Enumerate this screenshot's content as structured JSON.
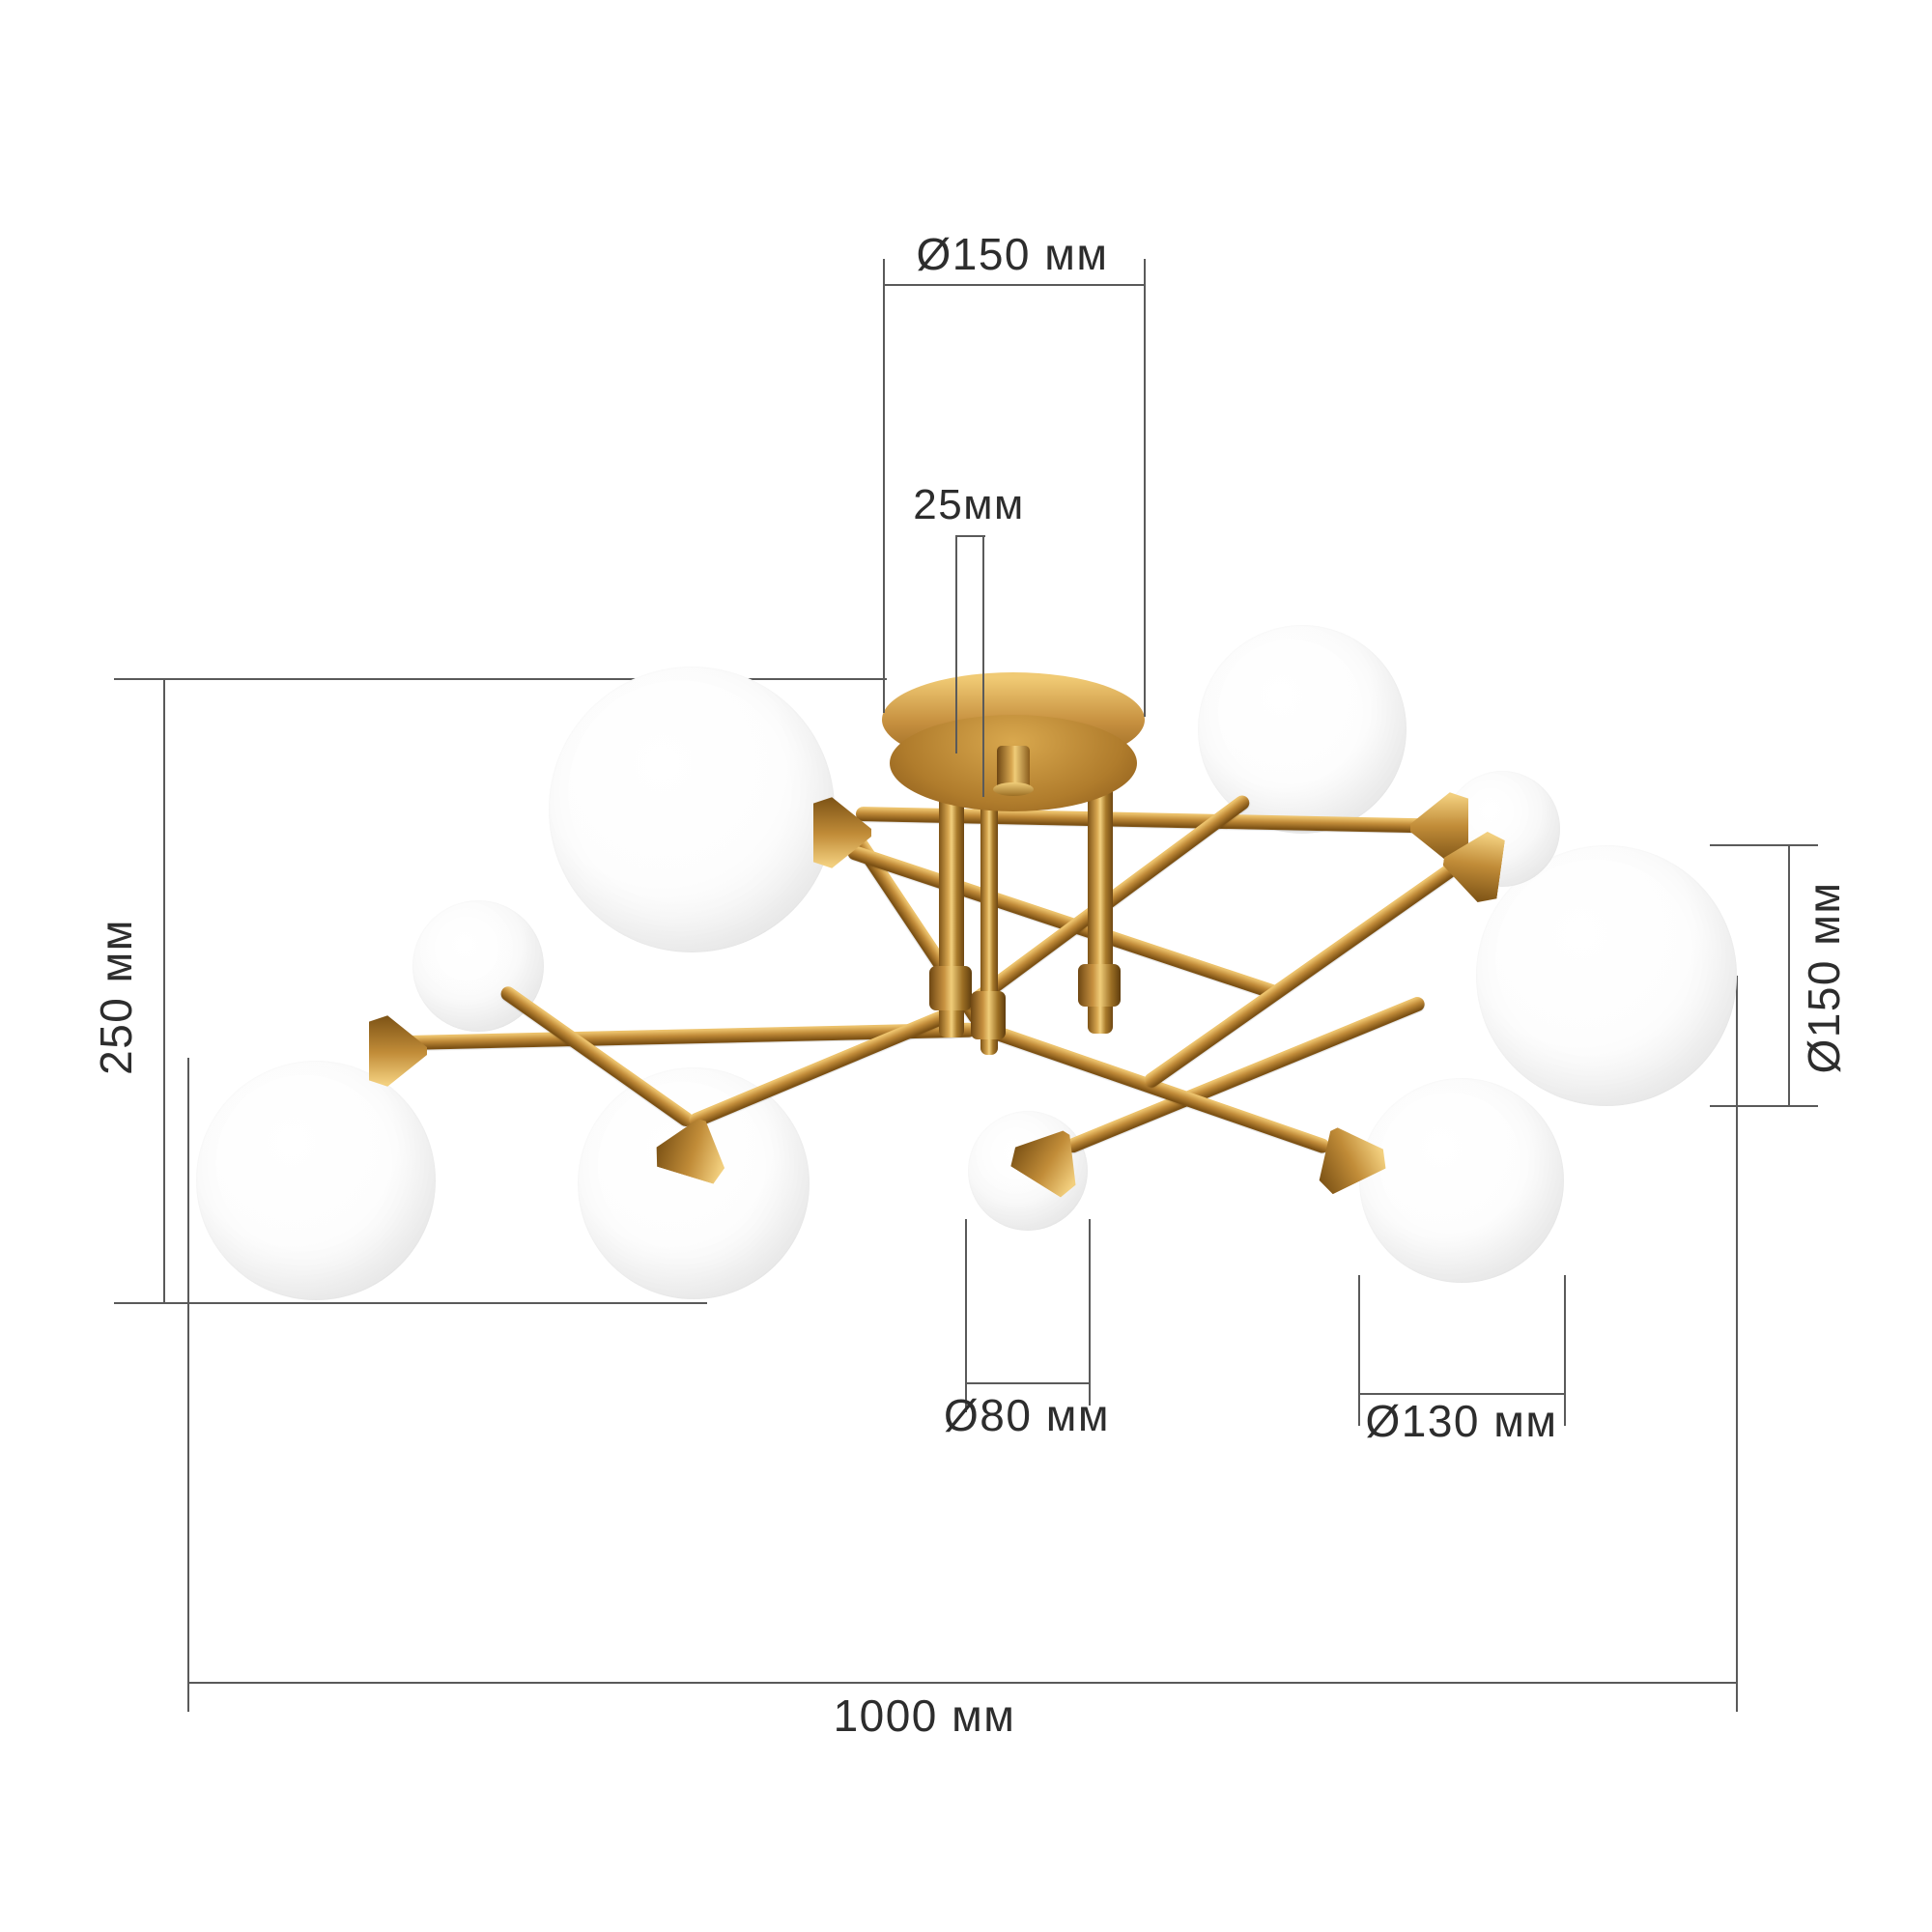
{
  "page": {
    "background": "#ffffff",
    "kind": "product dimension diagram",
    "product": "brass sputnik ceiling chandelier with opal glass globes"
  },
  "colors": {
    "brass": "#b5822e",
    "brass_highlight": "#f0cd79",
    "brass_shadow": "#7c5114",
    "glass_globe": "#ffffff",
    "dimension_line": "#5a5a5a",
    "dimension_text": "#2d2d2d"
  },
  "fixture": {
    "globe_count": 9
  },
  "dimensions": {
    "canopy_diameter": {
      "label": "Ø150 мм",
      "value": 150,
      "unit": "мм"
    },
    "stem_diameter": {
      "label": "25мм",
      "value": 25,
      "unit": "мм"
    },
    "height": {
      "label": "250 мм",
      "value": 250,
      "unit": "мм"
    },
    "right_globe_diameter": {
      "label": "Ø150 мм",
      "value": 150,
      "unit": "мм"
    },
    "small_globe_diameter": {
      "label": "Ø80 мм",
      "value": 80,
      "unit": "мм"
    },
    "bottom_globe_diameter": {
      "label": "Ø130 мм",
      "value": 130,
      "unit": "мм"
    },
    "total_width": {
      "label": "1000 мм",
      "value": 1000,
      "unit": "мм"
    }
  }
}
